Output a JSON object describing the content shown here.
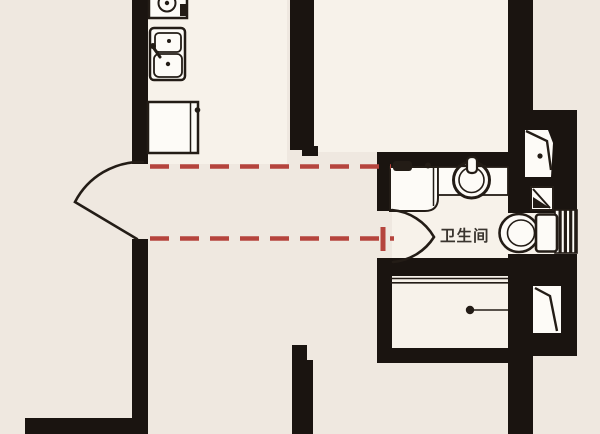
{
  "floorplan": {
    "room_label": "卫生间",
    "colors": {
      "background": "#efe8e0",
      "interior": "#f7f2ea",
      "wall": "#1a1410",
      "fixture_white": "#fdfbf7",
      "ink": "#231c16",
      "dashed_line_red": "#b5443d",
      "label_text": "#3a352f"
    }
  }
}
